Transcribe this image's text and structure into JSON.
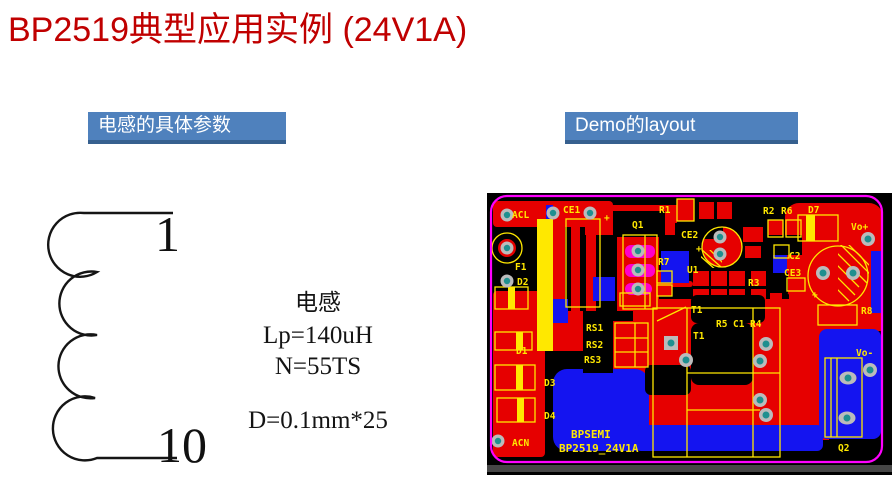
{
  "slide": {
    "title": "BP2519典型应用实例 (24V1A)"
  },
  "left_panel": {
    "header": "电感的具体参数",
    "coil": {
      "top_pin": "1",
      "bottom_pin": "10"
    },
    "specs": {
      "line1": "电感",
      "line2": "Lp=140uH",
      "line3": "N=55TS",
      "line4": "D=0.1mm*25"
    }
  },
  "right_panel": {
    "header": "Demo的layout",
    "pcb": {
      "refs": {
        "acl": "ACL",
        "ce1": "CE1",
        "plus_top": "+",
        "q1": "Q1",
        "r1": "R1",
        "r2": "R2",
        "r6": "R6",
        "d7": "D7",
        "vo_plus": "Vo+",
        "ce2": "CE2",
        "plus_ce2": "+",
        "f1": "F1",
        "d2": "D2",
        "r7": "R7",
        "u1": "U1",
        "c2": "C2",
        "ce3": "CE3",
        "r3": "R3",
        "t1_top": "T1",
        "r5": "R5",
        "c1": "C1",
        "r4": "R4",
        "r8": "R8",
        "rs1": "RS1",
        "rs2": "RS2",
        "rs3": "RS3",
        "t1": "T1",
        "d1": "D1",
        "d3": "D3",
        "d4": "D4",
        "acn": "ACN",
        "vo_minus": "Vo-",
        "q2": "Q2",
        "plus_cap": "+"
      },
      "brand_line1": "BPSEMI",
      "brand_line2": "BP2519_24V1A"
    }
  },
  "colors": {
    "title": "#c00000",
    "header_bg": "#4f81bd",
    "header_edge": "#36608f",
    "pcb_red": "#e60000",
    "pcb_blue": "#1414f0",
    "pcb_yellow": "#ffe800",
    "pcb_border": "#ff00ff",
    "pad_teal": "#1f8f8f",
    "pad_ring": "#bbbbbb"
  }
}
